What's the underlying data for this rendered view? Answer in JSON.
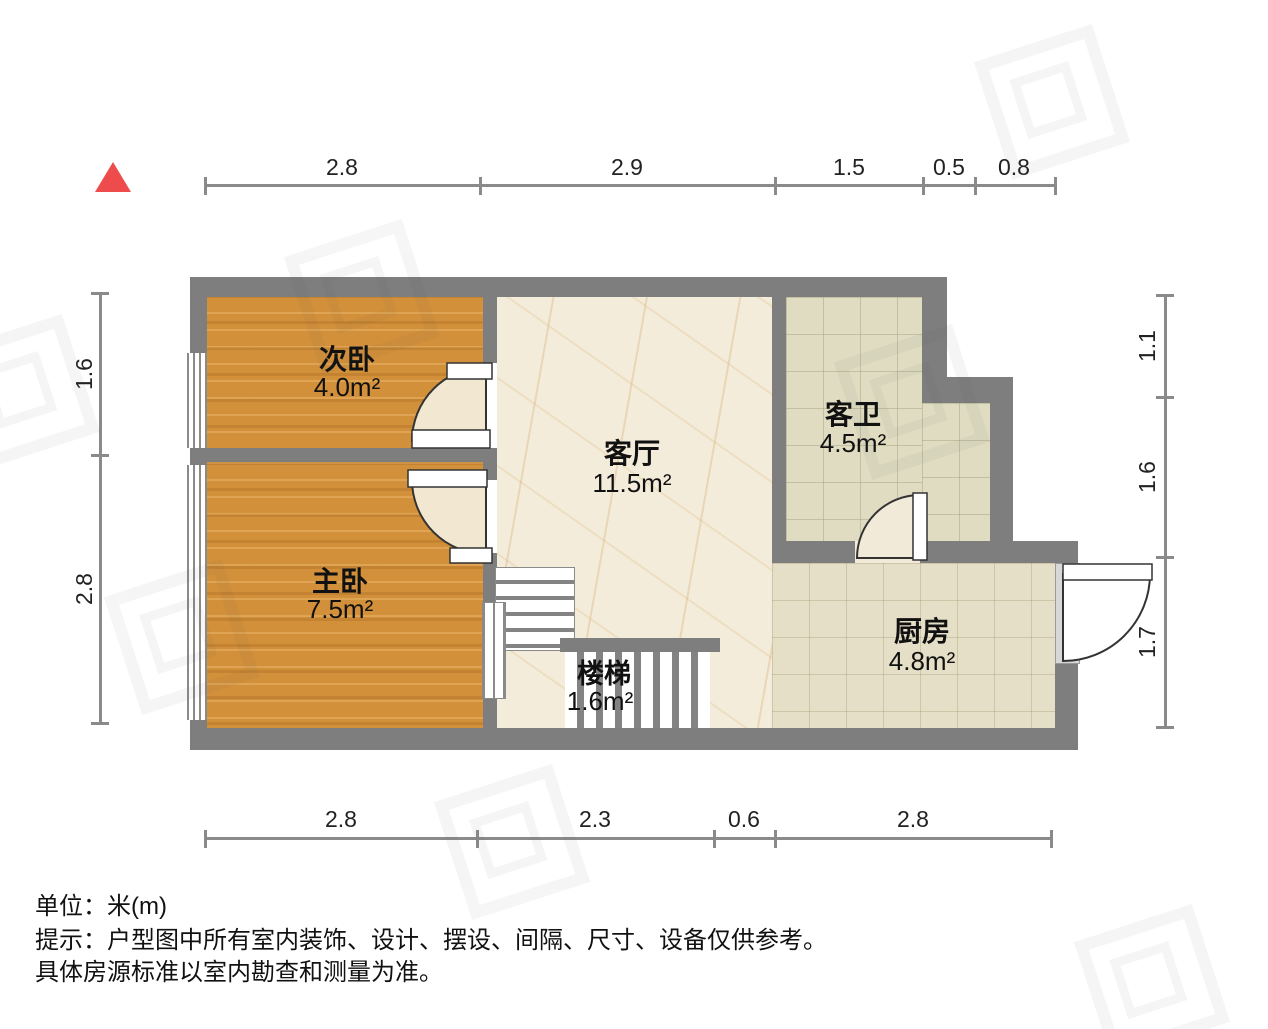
{
  "rooms": {
    "second_bedroom": {
      "name": "次卧",
      "area": "4.0m²"
    },
    "master_bedroom": {
      "name": "主卧",
      "area": "7.5m²"
    },
    "living_room": {
      "name": "客厅",
      "area": "11.5m²"
    },
    "guest_bathroom": {
      "name": "客卫",
      "area": "4.5m²"
    },
    "kitchen": {
      "name": "厨房",
      "area": "4.8m²"
    },
    "stairs": {
      "name": "楼梯",
      "area": "1.6m²"
    }
  },
  "dimensions": {
    "top": [
      "2.8",
      "2.9",
      "1.5",
      "0.5",
      "0.8"
    ],
    "bottom": [
      "2.8",
      "2.3",
      "0.6",
      "2.8"
    ],
    "left": [
      "1.6",
      "2.8"
    ],
    "right": [
      "1.1",
      "1.6",
      "1.7"
    ]
  },
  "footer": {
    "unit": "单位：米(m)",
    "tip": "提示：户型图中所有室内装饰、设计、摆设、间隔、尺寸、设备仅供参考。",
    "tip2": "具体房源标准以室内勘查和测量为准。"
  },
  "colors": {
    "accent": "#ee4c4c",
    "wall": "#7e7e7e",
    "wood": "#d2903a",
    "marble": "#f4ecda",
    "bathtile": "#dfdcc2",
    "kitchentile": "#e6dfc8",
    "dim": "#8a8a8a"
  }
}
